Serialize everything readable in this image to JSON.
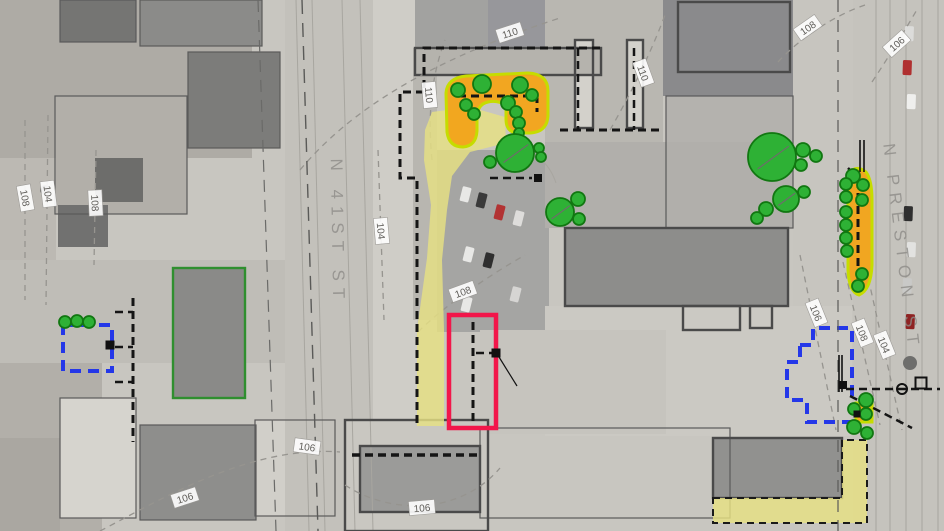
{
  "streets": [
    {
      "name": "N 41ST ST",
      "x": 332,
      "y": 232,
      "angle": 89
    },
    {
      "name": "N PRESTON ST",
      "x": 896,
      "y": 248,
      "angle": 83
    }
  ],
  "contour_labels": [
    {
      "text": "110",
      "x": 510,
      "y": 33,
      "a": -18
    },
    {
      "text": "110",
      "x": 429,
      "y": 95,
      "a": 85
    },
    {
      "text": "110",
      "x": 643,
      "y": 73,
      "a": 70
    },
    {
      "text": "108",
      "x": 25,
      "y": 198,
      "a": 80
    },
    {
      "text": "104",
      "x": 48,
      "y": 194,
      "a": 83
    },
    {
      "text": "108",
      "x": 95,
      "y": 203,
      "a": 87
    },
    {
      "text": "104",
      "x": 381,
      "y": 231,
      "a": 85
    },
    {
      "text": "108",
      "x": 463,
      "y": 292,
      "a": -20
    },
    {
      "text": "106",
      "x": 185,
      "y": 498,
      "a": -18
    },
    {
      "text": "106",
      "x": 307,
      "y": 447,
      "a": 8
    },
    {
      "text": "106",
      "x": 422,
      "y": 508,
      "a": -5
    },
    {
      "text": "108",
      "x": 808,
      "y": 28,
      "a": -35
    },
    {
      "text": "106",
      "x": 897,
      "y": 44,
      "a": -42
    },
    {
      "text": "106",
      "x": 816,
      "y": 313,
      "a": 68
    },
    {
      "text": "108",
      "x": 862,
      "y": 333,
      "a": 68
    },
    {
      "text": "104",
      "x": 884,
      "y": 345,
      "a": 68
    }
  ],
  "colors": {
    "base": "#c8c6c0",
    "tree_fill": "#2eb135",
    "tree_stroke": "#117711",
    "orange_planting": "#f3a51c",
    "lime_border": "#c6dc00",
    "yellow_path": "#e7e182",
    "blue_dashed_zone": "#2437e8",
    "red_highlight_box": "#f2164a",
    "site_boundary": "#151515",
    "contour_line": "#96948f",
    "building_stroke": "#4a4a4a",
    "green_building_stroke": "#2f8f2f",
    "street_label": "#8e8c88"
  },
  "contour_paths": [
    "M 300,170 C 350,110 430,60 560,18",
    "M 432,160 C 428,120 430,80 445,40",
    "M 610,130 C 630,95 650,55 665,15",
    "M 25,120 L 25,300",
    "M 48,115 L 46,305",
    "M 96,150 L 94,265",
    "M 378,150 L 384,320",
    "M 418,332 C 445,305 490,275 525,255",
    "M 100,531 C 160,500 250,445 340,452",
    "M 345,485 C 390,515 460,515 500,468",
    "M 800,255 L 836,430",
    "M 843,262 L 880,425",
    "M 866,268 L 902,430",
    "M 778,62 C 800,38 835,15 865,5",
    "M 872,82 C 890,55 905,30 918,8"
  ],
  "boundaries": [
    {
      "d": "M 600,48 L 424,48 L 424,92",
      "w": 3
    },
    {
      "d": "M 424,92 L 400,92 L 400,178 L 417,178 L 417,428",
      "w": 3
    },
    {
      "d": "M 352,455 L 480,455",
      "w": 3.5
    },
    {
      "d": "M 578,48 L 578,130",
      "w": 2.5
    },
    {
      "d": "M 634,48 L 634,130",
      "w": 2.5
    },
    {
      "d": "M 560,130 L 662,130",
      "w": 3
    },
    {
      "d": "M 458,96 L 537,96 L 537,112",
      "w": 3
    },
    {
      "d": "M 490,178 L 532,178",
      "w": 2.5
    },
    {
      "d": "M 473,322 L 473,424",
      "w": 3
    },
    {
      "d": "M 476,353 L 492,353",
      "w": 2.5
    },
    {
      "d": "M 133,298 L 133,442",
      "w": 3
    },
    {
      "d": "M 115,312 L 133,312 M 115,347 L 133,347 M 115,382 L 133,382",
      "w": 2.5
    },
    {
      "d": "M 846,389 L 940,389",
      "w": 2.5
    },
    {
      "d": "M 850,396 L 912,428",
      "w": 2.5
    },
    {
      "d": "M 858,180 L 858,288",
      "w": 3
    },
    {
      "d": "M 848,168 L 868,188",
      "w": 2.5
    },
    {
      "d": "M 302,0 L 318,531",
      "w": 1.4,
      "dash": "14 9",
      "c": "#5a5a58"
    },
    {
      "d": "M 258,0 L 276,531",
      "w": 1.2,
      "dash": "12 8",
      "c": "#6a6a68"
    },
    {
      "d": "M 838,0 L 838,531",
      "w": 1.2,
      "dash": "12 8",
      "c": "#5a5a58"
    }
  ],
  "solid_lines": [
    {
      "d": "M 839,355 L 839,392",
      "w": 1.6
    },
    {
      "d": "M 842,355 L 842,392",
      "w": 1.6
    },
    {
      "d": "M 860,140 L 860,172",
      "w": 1.6
    },
    {
      "d": "M 864,140 L 864,172",
      "w": 1.6
    },
    {
      "d": "M 499,357 L 517,386",
      "w": 1.2
    }
  ],
  "street_lines": [
    "M 296,0 L 309,531",
    "M 312,0 L 325,531",
    "M 342,0 L 355,531",
    "M 360,0 L 373,531",
    "M 876,0 L 876,531",
    "M 890,0 L 890,531",
    "M 906,0 L 906,531",
    "M 922,0 L 922,531",
    "M 938,0 L 938,531",
    "M 505,143 Q 545,150 556,183"
  ],
  "areas": {
    "yellow_paths": [
      {
        "d": "M 425,130 L 432,112 L 470,107 L 505,117 L 506,143 L 470,152 L 452,176 L 447,210 L 442,260 L 444,330 L 444,426 L 417,426 L 417,330 L 427,258 L 431,205 L 424,160 Z",
        "dashed": false
      },
      {
        "d": "M 713,498 L 842,498 L 842,440 L 867,440 L 867,523 L 713,523 Z",
        "dashed": true
      }
    ],
    "orange_areas": [
      {
        "d": "M 446,93 Q 447,78 466,76 L 528,73 Q 548,74 548,91 L 548,116 Q 547,132 530,133 L 517,133 Q 506,132 506,119 L 506,105 Q 497,100 488,102 Q 478,104 477,116 L 477,131 Q 476,146 463,147 Q 449,147 447,132 Z"
      },
      {
        "d": "M 848,174 Q 856,164 866,172 Q 872,180 872,200 L 872,265 Q 871,290 859,295 Q 849,292 848,270 Z"
      },
      {
        "d": "M 856,403 L 872,403 L 872,422 L 856,422 Z"
      }
    ],
    "blue_zones": [
      {
        "d": "M 63,325 L 112,325 L 112,371 L 63,371 Z"
      },
      {
        "d": "M 800,345 L 813,345 L 813,328 L 852,328 L 852,422 L 807,422 L 807,400 L 787,400 L 787,362 L 800,362 Z"
      }
    ],
    "red_zone": {
      "x": 449,
      "y": 315,
      "w": 47,
      "h": 113
    }
  },
  "trees": [
    [
      458,
      90,
      7
    ],
    [
      482,
      84,
      9
    ],
    [
      466,
      105,
      6
    ],
    [
      474,
      114,
      6
    ],
    [
      520,
      85,
      8
    ],
    [
      532,
      95,
      6
    ],
    [
      508,
      103,
      7
    ],
    [
      516,
      112,
      6
    ],
    [
      519,
      123,
      6
    ],
    [
      519,
      133,
      5
    ],
    [
      490,
      162,
      6
    ],
    [
      515,
      153,
      19
    ],
    [
      539,
      148,
      5
    ],
    [
      541,
      157,
      5
    ],
    [
      560,
      212,
      14
    ],
    [
      578,
      199,
      7
    ],
    [
      579,
      219,
      6
    ],
    [
      772,
      157,
      24
    ],
    [
      803,
      150,
      7
    ],
    [
      816,
      156,
      6
    ],
    [
      801,
      165,
      6
    ],
    [
      786,
      199,
      13
    ],
    [
      766,
      209,
      7
    ],
    [
      757,
      218,
      6
    ],
    [
      804,
      192,
      6
    ],
    [
      853,
      176,
      7
    ],
    [
      846,
      184,
      6
    ],
    [
      863,
      185,
      6
    ],
    [
      846,
      197,
      6
    ],
    [
      862,
      200,
      6
    ],
    [
      846,
      212,
      6
    ],
    [
      846,
      225,
      6
    ],
    [
      846,
      238,
      6
    ],
    [
      847,
      251,
      6
    ],
    [
      862,
      274,
      6
    ],
    [
      858,
      286,
      6
    ],
    [
      866,
      400,
      7
    ],
    [
      854,
      409,
      6
    ],
    [
      866,
      414,
      6
    ],
    [
      854,
      427,
      7
    ],
    [
      867,
      433,
      6
    ],
    [
      65,
      322,
      6
    ],
    [
      77,
      321,
      6
    ],
    [
      89,
      322,
      6
    ]
  ],
  "markers": {
    "filled_squares": [
      [
        538,
        178,
        8
      ],
      [
        496,
        353,
        9
      ],
      [
        110,
        345,
        9
      ],
      [
        843,
        385,
        8
      ],
      [
        857,
        414,
        7
      ]
    ],
    "open_squares": [
      [
        921,
        383,
        11
      ]
    ],
    "open_circles": [
      [
        902,
        389,
        5
      ]
    ],
    "gray_circles": [
      [
        910,
        363,
        7
      ],
      [
        45,
        190,
        5
      ]
    ]
  },
  "background": {
    "patches": [
      [
        0,
        0,
        252,
        158,
        "#aeaba5"
      ],
      [
        60,
        0,
        76,
        42,
        "#757573"
      ],
      [
        140,
        0,
        122,
        46,
        "#8b8b89"
      ],
      [
        188,
        52,
        92,
        96,
        "#7c7c7a"
      ],
      [
        55,
        96,
        132,
        118,
        "#b2afa9"
      ],
      [
        95,
        158,
        48,
        44,
        "#6d6d6b"
      ],
      [
        58,
        205,
        50,
        42,
        "#717170"
      ],
      [
        0,
        158,
        56,
        205,
        "#bcb9b3"
      ],
      [
        0,
        363,
        102,
        168,
        "#b2afa9"
      ],
      [
        60,
        398,
        76,
        120,
        "#d6d4ce"
      ],
      [
        140,
        425,
        116,
        95,
        "#8e8e8c"
      ],
      [
        255,
        420,
        80,
        96,
        "#d1cfc9"
      ],
      [
        285,
        0,
        88,
        531,
        "#c3c1bb"
      ],
      [
        373,
        0,
        44,
        531,
        "#cfcdc7"
      ],
      [
        415,
        0,
        172,
        48,
        "#a2a2a0"
      ],
      [
        488,
        0,
        57,
        48,
        "#97979b"
      ],
      [
        545,
        0,
        118,
        142,
        "#b9b7b1"
      ],
      [
        663,
        0,
        130,
        96,
        "#8a8a8c"
      ],
      [
        793,
        0,
        60,
        531,
        "#c7c5bf"
      ],
      [
        853,
        0,
        91,
        531,
        "#c5c3bd"
      ],
      [
        666,
        96,
        127,
        132,
        "#b4b2ae"
      ],
      [
        437,
        150,
        112,
        182,
        "#a5a5a3"
      ],
      [
        545,
        142,
        248,
        86,
        "#b1afab"
      ],
      [
        565,
        228,
        223,
        78,
        "#8d8d8b"
      ],
      [
        545,
        306,
        307,
        130,
        "#cbc9c3"
      ],
      [
        480,
        330,
        186,
        104,
        "#c6c4be"
      ],
      [
        345,
        420,
        143,
        111,
        "#c9c7c1"
      ],
      [
        360,
        446,
        120,
        66,
        "#9b9b99"
      ],
      [
        713,
        438,
        129,
        60,
        "#91918f"
      ],
      [
        0,
        260,
        285,
        103,
        "#bfbdb7"
      ],
      [
        173,
        268,
        72,
        130,
        "#8a8a88"
      ],
      [
        575,
        40,
        18,
        88,
        "#d3d1cb"
      ],
      [
        627,
        40,
        16,
        88,
        "#d3d1cb"
      ],
      [
        413,
        48,
        190,
        28,
        "#b5b3ad"
      ],
      [
        413,
        76,
        24,
        244,
        "#b8b6b0"
      ],
      [
        0,
        438,
        60,
        93,
        "#aaa7a1"
      ]
    ]
  },
  "buildings": {
    "thin": [
      [
        60,
        0,
        76,
        42
      ],
      [
        140,
        0,
        122,
        46
      ],
      [
        188,
        52,
        92,
        96
      ],
      [
        55,
        96,
        132,
        118
      ],
      [
        60,
        398,
        76,
        120
      ],
      [
        140,
        425,
        116,
        95
      ],
      [
        255,
        420,
        80,
        96
      ],
      [
        480,
        428,
        250,
        90
      ],
      [
        666,
        96,
        127,
        132
      ]
    ],
    "thick": [
      [
        575,
        40,
        18,
        88
      ],
      [
        627,
        40,
        16,
        88
      ],
      [
        678,
        2,
        112,
        70
      ],
      [
        565,
        228,
        223,
        78
      ],
      [
        683,
        306,
        57,
        24
      ],
      [
        750,
        306,
        22,
        22
      ],
      [
        345,
        420,
        143,
        111
      ],
      [
        360,
        446,
        120,
        66
      ],
      [
        713,
        438,
        129,
        60
      ],
      [
        415,
        48,
        186,
        27
      ]
    ],
    "green_outlined": [
      173,
      268,
      72,
      130
    ]
  },
  "cars": [
    [
      463,
      186,
      "#e8e8e6",
      14
    ],
    [
      479,
      192,
      "#3a3a3a",
      14
    ],
    [
      497,
      204,
      "#b23333",
      14
    ],
    [
      516,
      210,
      "#dedddb",
      14
    ],
    [
      466,
      246,
      "#e8e8e6",
      14
    ],
    [
      486,
      252,
      "#2f2f2f",
      14
    ],
    [
      513,
      286,
      "#d6d5d3",
      14
    ],
    [
      464,
      296,
      "#e8e8e6",
      14
    ],
    [
      905,
      26,
      "#dcdcda",
      2
    ],
    [
      903,
      60,
      "#b03030",
      2
    ],
    [
      907,
      94,
      "#efefed",
      2
    ],
    [
      904,
      206,
      "#2f2f2f",
      2
    ],
    [
      907,
      242,
      "#e2e2e0",
      2
    ],
    [
      903,
      278,
      "#c9c9c7",
      2
    ],
    [
      906,
      314,
      "#8f2323",
      2
    ]
  ]
}
